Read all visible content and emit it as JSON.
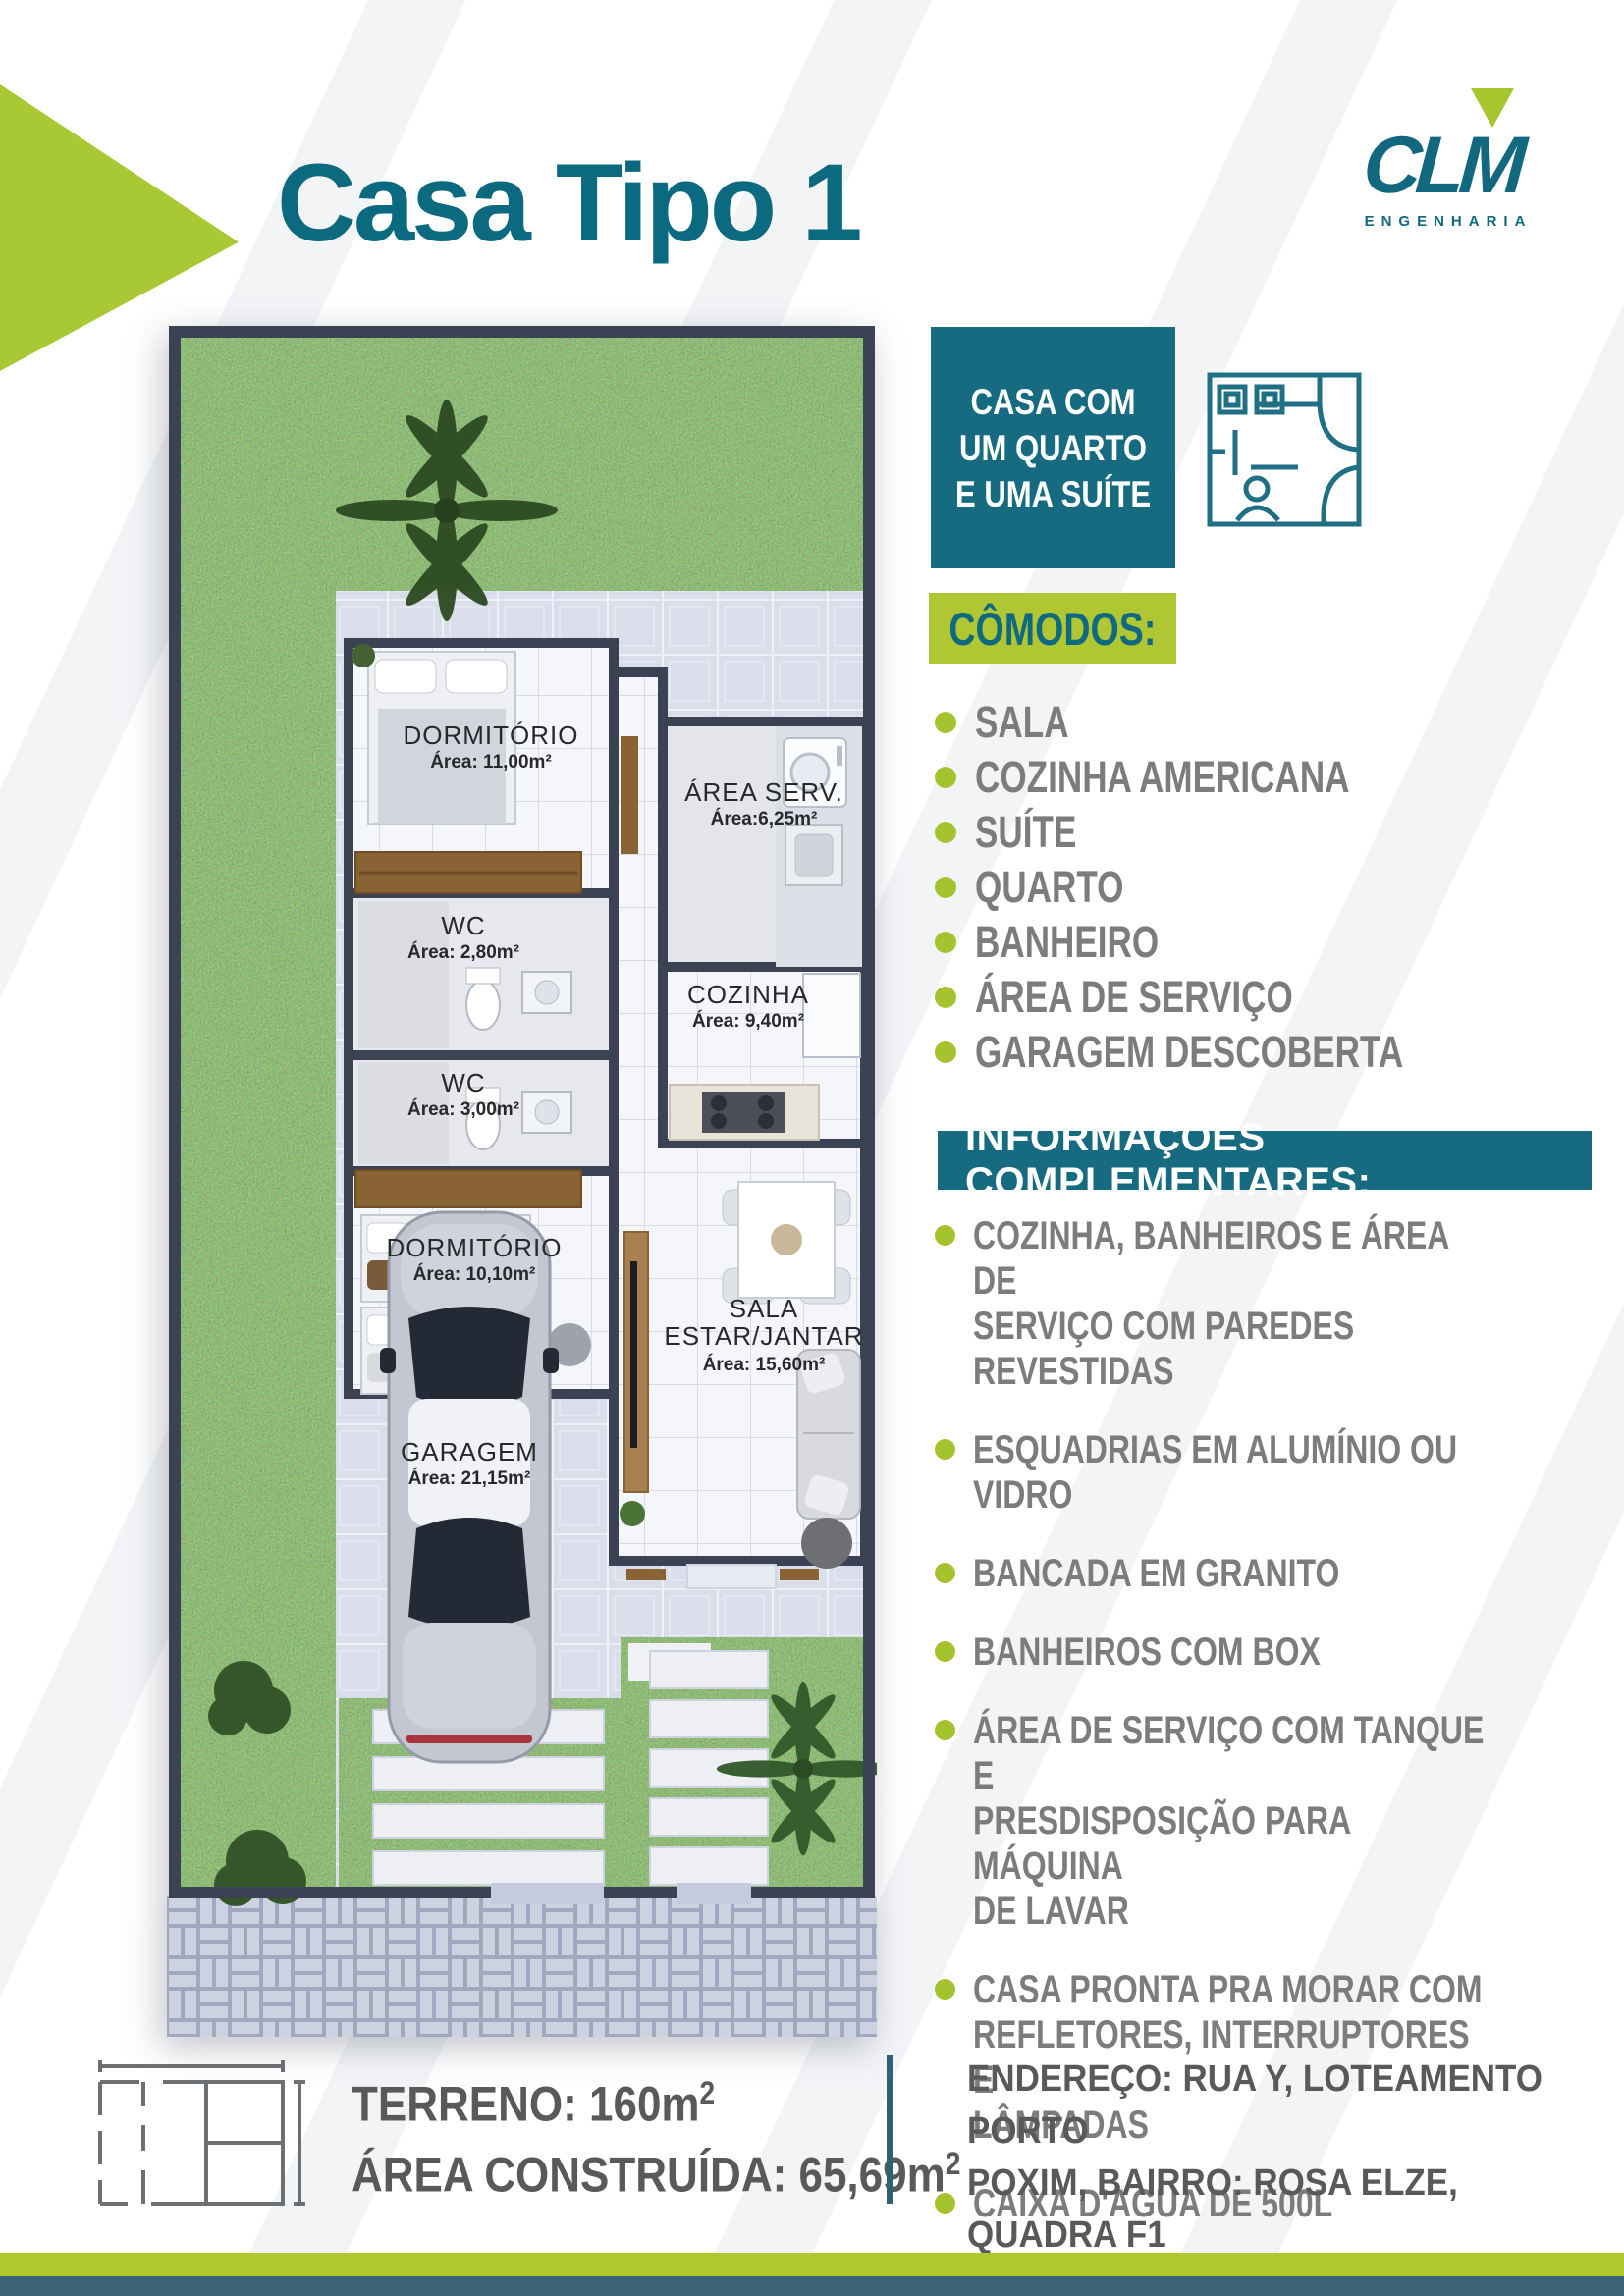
{
  "page_title": "Casa Tipo 1",
  "logo": {
    "brand": "CLM",
    "subtitle": "ENGENHARIA"
  },
  "badge": {
    "text": "CASA COM\nUM QUARTO\nE UMA SUÍTE"
  },
  "comodos": {
    "title": "CÔMODOS:",
    "items": [
      "SALA",
      "COZINHA AMERICANA",
      "SUÍTE",
      "QUARTO",
      "BANHEIRO",
      "ÁREA DE SERVIÇO",
      "GARAGEM DESCOBERTA"
    ]
  },
  "info": {
    "title": "INFORMAÇÕES COMPLEMENTARES:",
    "items": [
      "COZINHA, BANHEIROS E ÁREA DE\nSERVIÇO COM PAREDES REVESTIDAS",
      "ESQUADRIAS EM ALUMÍNIO OU VIDRO",
      "BANCADA EM GRANITO",
      "BANHEIROS COM BOX",
      "ÁREA DE SERVIÇO COM TANQUE  E\nPRESDISPOSIÇÃO PARA MÁQUINA\nDE LAVAR",
      "CASA PRONTA PRA MORAR COM\nREFLETORES, INTERRUPTORES E\nLÂMPADAS",
      "CAIXA D'AGUA DE 500L"
    ]
  },
  "stats": {
    "terreno": "TERRENO: 160m",
    "terreno_sup": "2",
    "area_construida": "ÁREA CONSTRUÍDA: 65,69m",
    "area_sup": "2"
  },
  "address": "ENDEREÇO: RUA Y, LOTEAMENTO PORTO\nPOXIM, BAIRRO: ROSA ELZE, QUADRA F1\nLOTE 1228, SÃO CRISTÓVÃO -SE.",
  "floorplan": {
    "rooms": [
      {
        "name": "DORMITÓRIO",
        "area": "Área: 11,00m²"
      },
      {
        "name": "ÁREA SERV.",
        "area": "Área:6,25m²"
      },
      {
        "name": "WC",
        "area": "Área: 2,80m²"
      },
      {
        "name": "COZINHA",
        "area": "Área: 9,40m²"
      },
      {
        "name": "WC",
        "area": "Área: 3,00m²"
      },
      {
        "name": "DORMITÓRIO",
        "area": "Área: 10,10m²"
      },
      {
        "name": "SALA",
        "name2": "ESTAR/JANTAR",
        "area": "Área: 15,60m²"
      },
      {
        "name": "GARAGEM",
        "area": "Área: 21,15m²"
      }
    ]
  },
  "icons": [
    "clm-logo",
    "floorplan-badge-icon",
    "mini-floorplan-icon",
    "palm-tree-icon",
    "car-top-view"
  ],
  "colors": {
    "teal": "#166b80",
    "title_teal": "#0c6a80",
    "green": "#a9c934",
    "list_green": "#a5c32e",
    "gray_text": "#7b7c7e",
    "dark_text": "#58595b",
    "wall": "#3a4254",
    "footer_teal": "#3c6478"
  }
}
